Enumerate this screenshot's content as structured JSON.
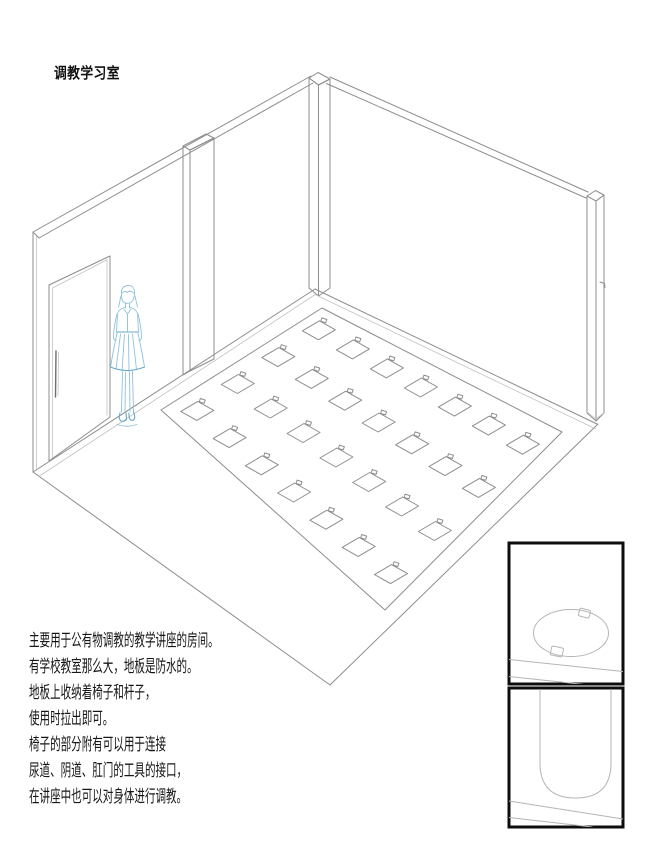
{
  "title": "调教学习室",
  "description": {
    "lines": [
      "主要用于公有物调教的教学讲座的房间。",
      "有学校教室那么大，地板是防水的。",
      "地板上收纳着椅子和杆子，",
      "使用时拉出即可。",
      "椅子的部分附有可以用于连接",
      "尿道、阴道、肛门的工具的接口，",
      "在讲座中也可以对身体进行调教。"
    ]
  },
  "drawing": {
    "background_color": "#ffffff",
    "line_color": "#8d8d8d",
    "sketch_figure_color": "#8fc1da",
    "inset_border_color": "#0d0d0d",
    "floor_hatches": {
      "rows": 4,
      "cols": 7,
      "total": 28
    }
  },
  "insets": [
    {
      "name": "floor-hatch-top-view"
    },
    {
      "name": "floor-hatch-slot-view"
    }
  ]
}
